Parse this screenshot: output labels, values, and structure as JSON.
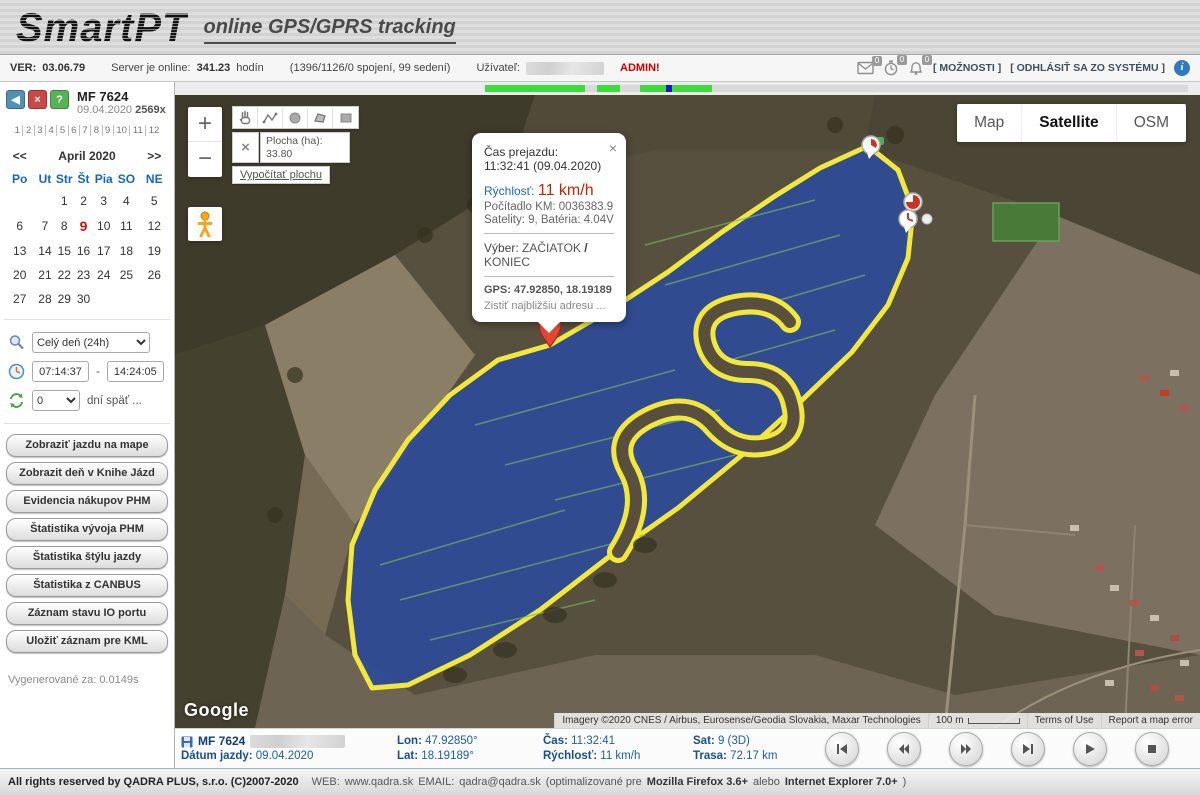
{
  "header": {
    "logo": "SmartPT",
    "tagline": "online GPS/GPRS tracking"
  },
  "toolbar": {
    "ver_label": "VER:",
    "ver": "03.06.79",
    "server_label": "Server je online:",
    "server_val": "341.23",
    "server_suffix": "hodín",
    "connections": "(1396/1126/0 spojení, 99 sedení)",
    "user_label": "Užívateľ:",
    "admin": "ADMIN!",
    "mail_badge": "0",
    "timer_badge": "0",
    "alarm_badge": "0",
    "options": "[ MOŽNOSTI ]",
    "logout": "[ ODHLÁSIŤ SA ZO SYSTÉMU ]",
    "info": "i"
  },
  "sidebar": {
    "nav_back": "◀",
    "nav_close": "×",
    "nav_help": "?",
    "vehicle": "MF 7624",
    "date": "09.04.2020",
    "count": "2569x",
    "months": [
      "1",
      "2",
      "3",
      "4",
      "5",
      "6",
      "7",
      "8",
      "9",
      "10",
      "11",
      "12"
    ],
    "calendar": {
      "prev": "<<",
      "title": "April 2020",
      "next": ">>",
      "days": [
        "Po",
        "Ut",
        "Str",
        "Št",
        "Pia",
        "SO",
        "NE"
      ],
      "weeks": [
        [
          "",
          "",
          "1",
          "2",
          "3",
          "4",
          "5"
        ],
        [
          "6",
          "7",
          "8",
          "9",
          "10",
          "11",
          "12"
        ],
        [
          "13",
          "14",
          "15",
          "16",
          "17",
          "18",
          "19"
        ],
        [
          "20",
          "21",
          "22",
          "23",
          "24",
          "25",
          "26"
        ],
        [
          "27",
          "28",
          "29",
          "30",
          "",
          "",
          ""
        ]
      ]
    },
    "range_select": "Celý deň (24h)",
    "time_from": "07:14:37",
    "time_sep": "-",
    "time_to": "14:24:05",
    "days_back": "0",
    "days_back_label": "dní späť ...",
    "buttons": [
      "Zobraziť jazdu na mape",
      "Zobrazit deň v Knihe Jázd",
      "Evidencia nákupov PHM",
      "Štatistika vývoja PHM",
      "Štatistika štýlu jazdy",
      "Štatistika z CANBUS",
      "Záznam stavu IO portu",
      "Uložiť záznam pre KML"
    ],
    "generated": "Vygenerované za: 0.0149s"
  },
  "map": {
    "zoom_in": "+",
    "zoom_out": "−",
    "area_label": "Plocha (ha):",
    "area_value": "33.80",
    "area_close": "×",
    "compute": "Vypočítať plochu",
    "layers": [
      "Map",
      "Satellite",
      "OSM"
    ],
    "google": "Google",
    "attribution": "Imagery ©2020 CNES / Airbus, Eurosense/Geodia Slovakia, Maxar Technologies",
    "scale": "100 m",
    "terms": "Terms of Use",
    "report": "Report a map error",
    "popup": {
      "close": "×",
      "title": "Čas prejazdu:",
      "time": "11:32:41 (09.04.2020)",
      "speed_label": "Rýchlosť:",
      "speed": "11 km/h",
      "odometer": "Počítadlo KM: 0036383.9",
      "satellites": "Satelity: 9, Batéria: 4.04V",
      "select_label": "Výber:",
      "start": "ZAČIATOK",
      "separator": "/",
      "end": "KONIEC",
      "gps": "GPS: 47.92850, 18.19189",
      "address_link": "Zistiť najbližšiu adresu ..."
    }
  },
  "status": {
    "vehicle": "MF 7624",
    "date_label": "Dátum jazdy:",
    "date": "09.04.2020",
    "lon_label": "Lon:",
    "lon": "47.92850°",
    "lat_label": "Lat:",
    "lat": "18.19189°",
    "time_label": "Čas:",
    "time": "11:32:41",
    "speed_label": "Rýchlosť:",
    "speed": "11 km/h",
    "sat_label": "Sat:",
    "sat": "9 (3D)",
    "dist_label": "Trasa:",
    "dist": "72.17 km"
  },
  "footer": {
    "rights": "All rights reserved by QADRA PLUS, s.r.o. (C)2007-2020",
    "web_label": "WEB:",
    "web": "www.qadra.sk",
    "email_label": "EMAIL:",
    "email": "qadra@qadra.sk",
    "note_pre": "(optimalizované pre",
    "firefox": "Mozilla Firefox 3.6+",
    "note_mid": "alebo",
    "ie": "Internet Explorer 7.0+",
    "note_close": ")"
  }
}
